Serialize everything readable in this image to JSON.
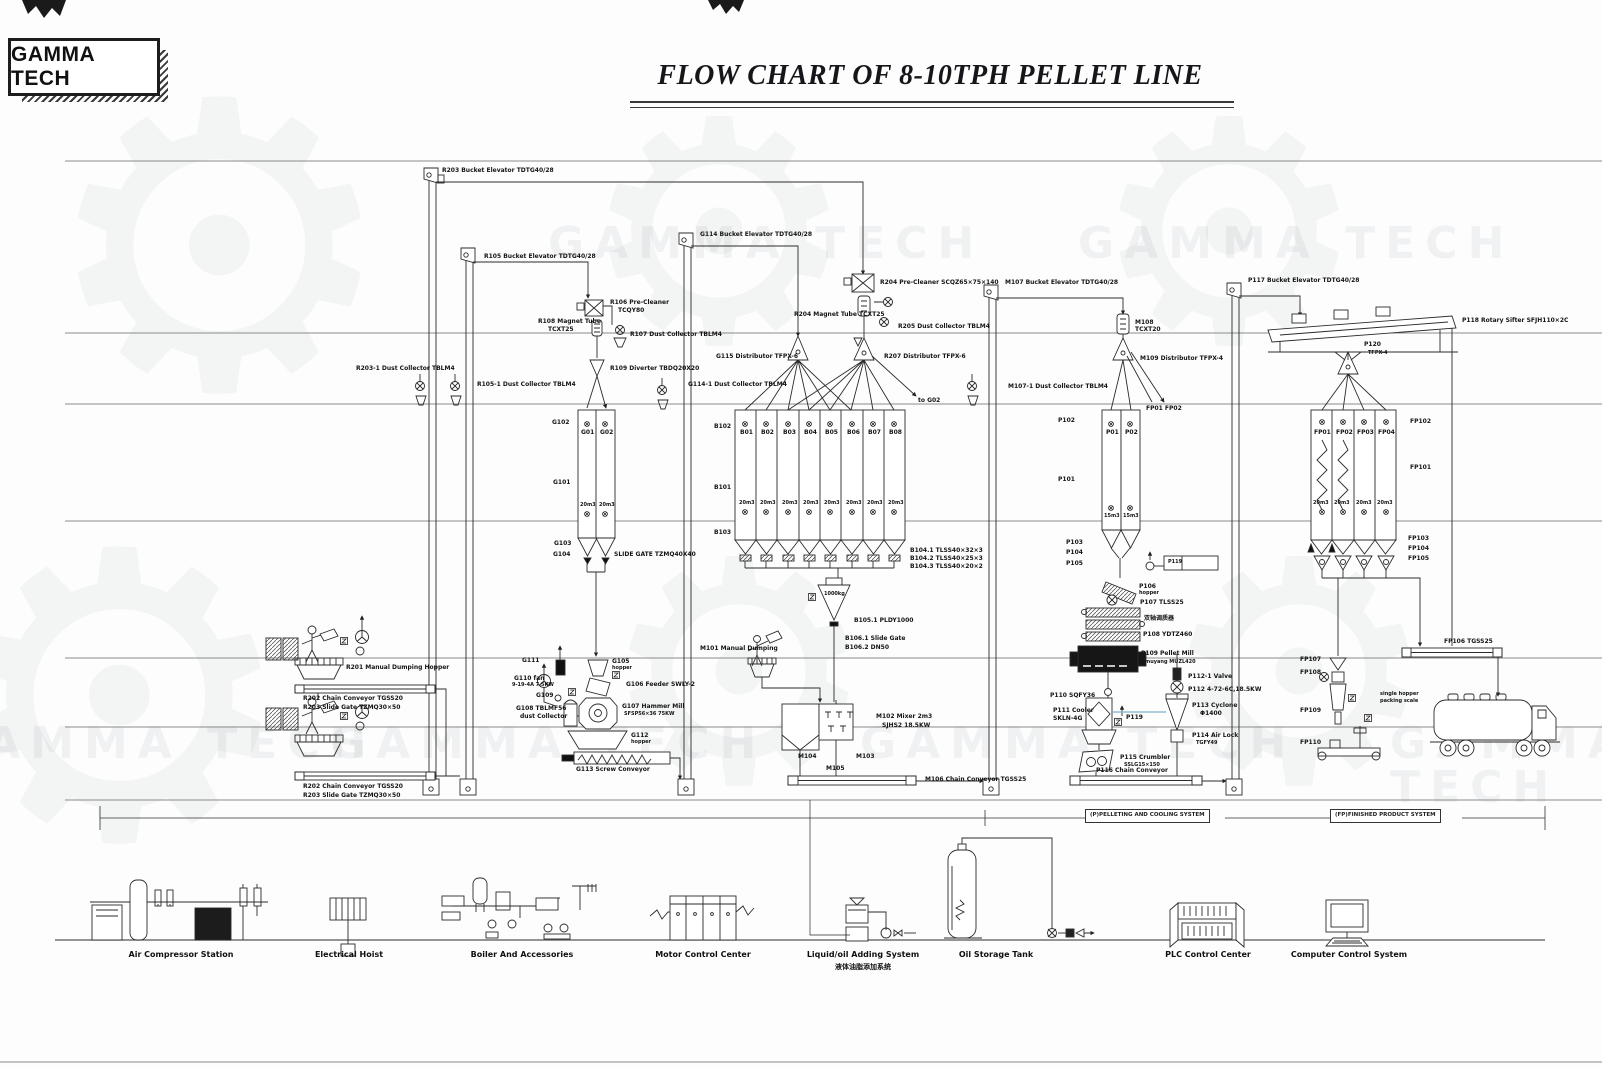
{
  "header": {
    "logo": "GAMMA TECH",
    "title": "FLOW CHART OF 8-10TPH PELLET LINE"
  },
  "watermark": {
    "text": "GAMMA TECH",
    "gear": "⚙"
  },
  "sections": {
    "pelleting": "(P)PELLETING AND COOLING SYSTEM",
    "finished": "(FP)FINISHED PRODUCT SYSTEM"
  },
  "bins": {
    "g": [
      "G01",
      "G02"
    ],
    "b": [
      "B01",
      "B02",
      "B03",
      "B04",
      "B05",
      "B06",
      "B07",
      "B08"
    ],
    "p": [
      "P01",
      "P02"
    ],
    "fp": [
      "FP01",
      "FP02",
      "FP03",
      "FP04"
    ],
    "cap20": "20m3",
    "cap15": "15m3"
  },
  "labels": {
    "r203_elev": "R203 Bucket Elevator TDTG40/28",
    "r105_elev": "R105 Bucket Elevator TDTG40/28",
    "r106_pre": "R106 Pre-Cleaner",
    "r106_pre_model": "TCQY80",
    "r108_mag": "R108 Magnet Tube",
    "r108_mag_model": "TCXT25",
    "r107_dust": "R107 Dust Collector TBLM4",
    "r203_1_dust": "R203-1 Dust Collector TBLM4",
    "r105_1_dust": "R105-1 Dust Collector TBLM4",
    "r109_div": "R109 Diverter TBDQ20X20",
    "r201": "R201 Manual Dumping Hopper",
    "r202": "R202 Chain Conveyor TGSS20",
    "r203_gate": "R203 Slide Gate TZMQ30×50",
    "g114_elev": "G114 Bucket Elevator TDTG40/28",
    "g114_1_dust": "G114-1 Dust Collector TBLM4",
    "g115_dist": "G115 Distributor TFPX-6",
    "r204_pre": "R204 Pre-Cleaner SCQZ65×75×140",
    "r204_mag": "R204 Magnet Tube TCXT25",
    "r205_dust": "R205 Dust Collector TBLM4",
    "r207_dist": "R207 Distributor TFPX-6",
    "to_g02": "to G02",
    "g102": "G102",
    "g101": "G101",
    "g103": "G103",
    "g104": "G104",
    "slide_gate": "SLIDE GATE TZMQ40X40",
    "g105": "G105",
    "g105_sub": "hopper",
    "g106": "G106 Feeder SWLY-2",
    "g107": "G107 Hammer Mill",
    "g107_model": "SFSP56×36 75KW",
    "g108": "G108 TBLMF56",
    "g108_sub": "dust Collector",
    "g109": "G109",
    "g110": "G110 fan",
    "g110_model": "9-19-4A 7.5KW",
    "g111": "G111",
    "g112": "G112",
    "g112_sub": "hopper",
    "g113": "G113 Screw Conveyor",
    "b102": "B102",
    "b101": "B101",
    "b103": "B103",
    "b104_1": "B104.1  TLSS40×32×3",
    "b104_2": "B104.2  TLSS40×25×3",
    "b104_3": "B104.3  TLSS40×20×2",
    "m101": "M101 Manual Dumping",
    "b105_1": "B105.1 PLDY1000",
    "b105_cap": "1000kg",
    "b106_1": "B106.1 Slide Gate",
    "b106_2": "B106.2 DN50",
    "m102": "M102 Mixer 2m3",
    "m102_model": "SJHS2 18.5KW",
    "m103": "M103",
    "m104": "M104",
    "m105": "M105",
    "m106": "M106 Chain Conveyor TGSS25",
    "m107_elev": "M107 Bucket Elevator TDTG40/28",
    "m108": "M108",
    "m108_model": "TCXT20",
    "m109_dist": "M109 Distributor TFPX-4",
    "m107_1_dust": "M107-1 Dust Collector TBLM4",
    "fp01_02": "FP01 FP02",
    "p102": "P102",
    "p101": "P101",
    "p103": "P103",
    "p104": "P104",
    "p105": "P105",
    "p119_box": "P119",
    "p106": "P106",
    "p106_sub": "hopper",
    "p107": "P107 TLSS25",
    "conditioner_cn": "双轴调质器",
    "p108": "P108 YDTZ460",
    "p109": "P109 Pellet Mill",
    "p109_model": "muyang MUZL420",
    "p110": "P110 SQFY36",
    "p111": "P111 Cooler",
    "p111_model": "SKLN-4G",
    "p119": "P119",
    "p112_1": "P112-1 Valve",
    "p112": "P112 4-72-6C,18.5KW",
    "p113": "P113 Cyclone",
    "p113_model": "Φ1400",
    "p114": "P114 Air Lock",
    "p114_model": "TGFY49",
    "p115": "P115 Crumbler",
    "p115_model": "SSLG15×150",
    "p116": "P116 Chain Conveyor",
    "p117_elev": "P117 Bucket Elevator TDTG40/28",
    "p118_sifter": "P118 Rotary Sifter SFJH110×2C",
    "p120": "P120",
    "p120_model": "TFPX-4",
    "fp102": "FP102",
    "fp101": "FP101",
    "fp103": "FP103",
    "fp104": "FP104",
    "fp105": "FP105",
    "fp106": "FP106 TGSS25",
    "fp107": "FP107",
    "fp108": "FP108",
    "fp109": "FP109",
    "fp110": "FP110",
    "pack_note1": "single hopper",
    "pack_note2": "packing scale"
  },
  "bottom": {
    "air": "Air Compressor Station",
    "hoist": "Electrical Hoist",
    "boiler": "Boiler And Accessories",
    "mcc": "Motor Control Center",
    "liquid": "Liquid/oil Adding System",
    "liquid_cn": "液体油脂添加系统",
    "oil": "Oil Storage Tank",
    "plc": "PLC Control Center",
    "computer": "Computer Control System"
  }
}
